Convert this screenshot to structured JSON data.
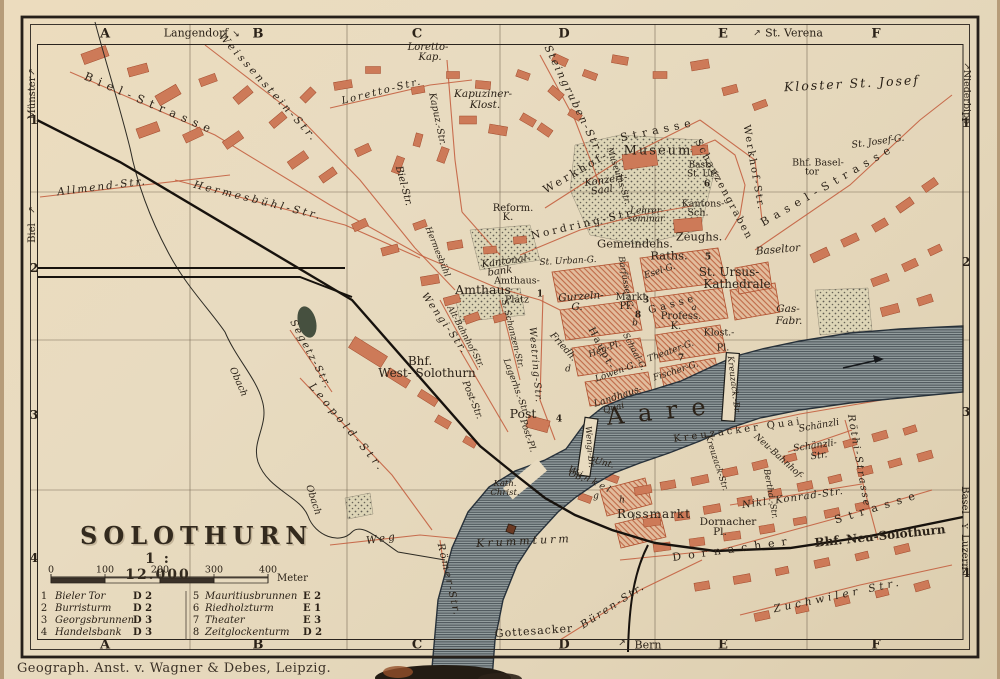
{
  "photo": {
    "credit": "Geograph. Anst. v. Wagner & Debes, Leipzig."
  },
  "map": {
    "title": "SOLOTHURN",
    "scale_text": "1 : 12.000",
    "scale_bar": {
      "unit": "Meter",
      "ticks": [
        {
          "t": "0",
          "x": 51
        },
        {
          "t": "100",
          "x": 105
        },
        {
          "t": "200",
          "x": 160
        },
        {
          "t": "300",
          "x": 214
        },
        {
          "t": "400",
          "x": 268
        }
      ]
    },
    "grid": {
      "cols": [
        {
          "t": "A",
          "x": 105
        },
        {
          "t": "B",
          "x": 258
        },
        {
          "t": "C",
          "x": 417
        },
        {
          "t": "D",
          "x": 564
        },
        {
          "t": "E",
          "x": 723
        },
        {
          "t": "F",
          "x": 876
        }
      ],
      "rows_left": [
        {
          "t": "1",
          "y": 120
        },
        {
          "t": "2",
          "y": 268
        },
        {
          "t": "3",
          "y": 415
        },
        {
          "t": "4",
          "y": 558
        }
      ],
      "rows_right": [
        {
          "t": "1",
          "y": 123
        },
        {
          "t": "2",
          "y": 262
        },
        {
          "t": "3",
          "y": 412
        },
        {
          "t": "4",
          "y": 573
        }
      ]
    },
    "legend": {
      "entries": [
        {
          "num": "1",
          "name": "Bieler Tor",
          "ref": "D 2"
        },
        {
          "num": "2",
          "name": "Burristurm",
          "ref": "D 2"
        },
        {
          "num": "3",
          "name": "Georgsbrunnen",
          "ref": "D 3"
        },
        {
          "num": "4",
          "name": "Handelsbank",
          "ref": "D 3"
        },
        {
          "num": "5",
          "name": "Mauritiusbrunnen",
          "ref": "E 2"
        },
        {
          "num": "6",
          "name": "Riedholzturm",
          "ref": "E 1"
        },
        {
          "num": "7",
          "name": "Theater",
          "ref": "E 3"
        },
        {
          "num": "8",
          "name": "Zeitglockenturm",
          "ref": "D 2"
        }
      ]
    },
    "colors": {
      "paper": "#e8dbc0",
      "ink": "#2b2218",
      "building_red": "#c2593a",
      "water": "#8f999c"
    },
    "labels": [
      {
        "t": "Langendorf",
        "x": 196,
        "y": 33,
        "s": 11,
        "n": "edge-label-langendorf"
      },
      {
        "t": "↘",
        "x": 236,
        "y": 35,
        "s": 9,
        "n": "direction-arrow"
      },
      {
        "t": "↗",
        "x": 757,
        "y": 34,
        "s": 9,
        "n": "direction-arrow"
      },
      {
        "t": "St. Verena",
        "x": 794,
        "y": 33,
        "s": 11,
        "n": "edge-label-st-verena"
      },
      {
        "t": "↗",
        "x": 33,
        "y": 72,
        "r": -90,
        "s": 9,
        "n": "direction-arrow"
      },
      {
        "t": "Münster",
        "x": 33,
        "y": 98,
        "r": -90,
        "s": 10,
        "n": "edge-label-muenster"
      },
      {
        "t": "↗",
        "x": 33,
        "y": 210,
        "r": -90,
        "s": 9,
        "n": "direction-arrow"
      },
      {
        "t": "Biel",
        "x": 33,
        "y": 233,
        "r": -90,
        "s": 10,
        "n": "edge-label-biel"
      },
      {
        "t": "↗",
        "x": 966,
        "y": 66,
        "r": 90,
        "s": 9,
        "n": "direction-arrow"
      },
      {
        "t": "Niederbipp",
        "x": 966,
        "y": 97,
        "r": 90,
        "s": 9.5,
        "n": "edge-label-niederbipp"
      },
      {
        "t": "Basel",
        "x": 964,
        "y": 500,
        "r": 90,
        "s": 10,
        "n": "edge-label-basel"
      },
      {
        "t": "Y",
        "x": 964,
        "y": 526,
        "r": 90,
        "s": 8,
        "n": "rail-fork-icon"
      },
      {
        "t": "Luzern",
        "x": 964,
        "y": 552,
        "r": 90,
        "s": 10,
        "n": "edge-label-luzern"
      },
      {
        "t": "↗",
        "x": 622,
        "y": 644,
        "s": 9,
        "n": "direction-arrow"
      },
      {
        "t": "Bern",
        "x": 648,
        "y": 645,
        "s": 11,
        "n": "edge-label-bern"
      },
      {
        "t": "Weissenstein-Str.",
        "x": 268,
        "y": 88,
        "r": 48,
        "s": 10.5,
        "i": 1,
        "ls": 3
      },
      {
        "t": "Biel-Strasse",
        "x": 150,
        "y": 104,
        "r": 23,
        "s": 11.5,
        "ls": 6
      },
      {
        "t": "Loretto-Str.",
        "x": 382,
        "y": 92,
        "r": -14,
        "s": 10,
        "i": 1,
        "ls": 2
      },
      {
        "t": "Loretto-",
        "x": 428,
        "y": 48,
        "s": 10,
        "i": 1
      },
      {
        "t": "Kap.",
        "x": 430,
        "y": 58,
        "s": 10,
        "i": 1
      },
      {
        "t": "Kapuziner-",
        "x": 483,
        "y": 94,
        "s": 10.5,
        "i": 1
      },
      {
        "t": "Klost.",
        "x": 485,
        "y": 105,
        "s": 10.5,
        "i": 1
      },
      {
        "t": "Kapuz.-Str.",
        "x": 437,
        "y": 119,
        "r": 78,
        "s": 9.5,
        "i": 1
      },
      {
        "t": "Allmend-Str.",
        "x": 102,
        "y": 187,
        "r": -7,
        "s": 10.5,
        "i": 1,
        "ls": 2
      },
      {
        "t": "Hermesbühl-Str.",
        "x": 258,
        "y": 201,
        "r": 14,
        "s": 10.5,
        "i": 1,
        "ls": 3
      },
      {
        "t": "Biel-Str.",
        "x": 403,
        "y": 186,
        "r": 75,
        "s": 10,
        "i": 1
      },
      {
        "t": "Hermesbühl",
        "x": 437,
        "y": 252,
        "r": 68,
        "s": 8.5,
        "i": 1
      },
      {
        "t": "Steingruben-Str.",
        "x": 573,
        "y": 100,
        "r": 64,
        "s": 10.5,
        "i": 1,
        "ls": 2
      },
      {
        "t": "Werkhof-",
        "x": 576,
        "y": 172,
        "r": -30,
        "s": 11,
        "ls": 3
      },
      {
        "t": "Strasse",
        "x": 658,
        "y": 130,
        "r": -12,
        "s": 11,
        "ls": 5
      },
      {
        "t": "Werkhof-Str.",
        "x": 753,
        "y": 168,
        "r": 80,
        "s": 10,
        "ls": 2
      },
      {
        "t": "Museum",
        "x": 658,
        "y": 151,
        "s": 13,
        "ls": 2
      },
      {
        "t": "Museums-Str.",
        "x": 618,
        "y": 176,
        "r": 72,
        "s": 8.5,
        "i": 1
      },
      {
        "t": "Konzert-",
        "x": 606,
        "y": 181,
        "r": -8,
        "s": 10,
        "i": 1
      },
      {
        "t": "Saal",
        "x": 602,
        "y": 191,
        "r": -8,
        "s": 10,
        "i": 1
      },
      {
        "t": "Schanzengraben",
        "x": 723,
        "y": 190,
        "r": 62,
        "s": 10,
        "ls": 2
      },
      {
        "t": "Bast.",
        "x": 700,
        "y": 166,
        "s": 9
      },
      {
        "t": "St. Urs",
        "x": 703,
        "y": 175,
        "s": 9
      },
      {
        "t": "6",
        "x": 707,
        "y": 185,
        "s": 9,
        "b": 1,
        "n": "map-ref-marker"
      },
      {
        "t": "Kloster St. Josef",
        "x": 852,
        "y": 84,
        "r": -3,
        "s": 12.5,
        "i": 1,
        "ls": 2
      },
      {
        "t": "Bhf. Basel-",
        "x": 818,
        "y": 163,
        "s": 9.5
      },
      {
        "t": "tor",
        "x": 812,
        "y": 172,
        "s": 9.5
      },
      {
        "t": "Basel-Strasse",
        "x": 828,
        "y": 185,
        "r": -30,
        "s": 11,
        "ls": 6
      },
      {
        "t": "St. Josef-G.",
        "x": 878,
        "y": 142,
        "r": -8,
        "s": 9.5,
        "i": 1
      },
      {
        "t": "Reform.",
        "x": 513,
        "y": 209,
        "s": 10
      },
      {
        "t": "K.",
        "x": 508,
        "y": 218,
        "s": 10
      },
      {
        "t": "Nordring-Str.",
        "x": 585,
        "y": 224,
        "r": -13,
        "s": 10.5,
        "ls": 3
      },
      {
        "t": "Lehrer-",
        "x": 647,
        "y": 212,
        "s": 9,
        "i": 1
      },
      {
        "t": "seminar",
        "x": 646,
        "y": 220,
        "s": 9,
        "i": 1
      },
      {
        "t": "Kantons-",
        "x": 703,
        "y": 204,
        "s": 9.5
      },
      {
        "t": "Sch.",
        "x": 698,
        "y": 213,
        "s": 9.5
      },
      {
        "t": "Gemeindehs.",
        "x": 635,
        "y": 244,
        "s": 11.5
      },
      {
        "t": "Zeughs.",
        "x": 699,
        "y": 237,
        "s": 11.5
      },
      {
        "t": "Raths.",
        "x": 669,
        "y": 256,
        "s": 11.5
      },
      {
        "t": "5",
        "x": 708,
        "y": 258,
        "s": 9,
        "b": 1,
        "n": "map-ref-marker"
      },
      {
        "t": "St. Ursus-",
        "x": 729,
        "y": 272,
        "s": 12
      },
      {
        "t": "Kathedrale",
        "x": 737,
        "y": 284,
        "s": 12
      },
      {
        "t": "Baseltor",
        "x": 778,
        "y": 250,
        "r": -5,
        "s": 10.5,
        "i": 1
      },
      {
        "t": "Gas-",
        "x": 788,
        "y": 309,
        "s": 10.5,
        "i": 1
      },
      {
        "t": "Fabr.",
        "x": 789,
        "y": 321,
        "s": 10.5,
        "i": 1
      },
      {
        "t": "Kantonal-",
        "x": 506,
        "y": 262,
        "r": -8,
        "s": 10,
        "i": 1
      },
      {
        "t": "bank",
        "x": 500,
        "y": 272,
        "r": -8,
        "s": 10,
        "i": 1
      },
      {
        "t": "St. Urban-G.",
        "x": 568,
        "y": 262,
        "r": -3,
        "s": 9,
        "i": 1
      },
      {
        "t": "Amthaus",
        "x": 483,
        "y": 290,
        "s": 12.5
      },
      {
        "t": "Amthaus-",
        "x": 517,
        "y": 281,
        "s": 9.5
      },
      {
        "t": "Platz",
        "x": 517,
        "y": 300,
        "s": 9.5
      },
      {
        "t": "1",
        "x": 540,
        "y": 295,
        "s": 9,
        "b": 1,
        "n": "map-ref-marker"
      },
      {
        "t": "Gurzeln-",
        "x": 581,
        "y": 297,
        "r": -4,
        "s": 10.5,
        "i": 1
      },
      {
        "t": "G.",
        "x": 577,
        "y": 307,
        "s": 10.5,
        "i": 1
      },
      {
        "t": "Markt",
        "x": 631,
        "y": 298,
        "s": 10
      },
      {
        "t": "Pl.",
        "x": 626,
        "y": 307,
        "s": 10
      },
      {
        "t": "3",
        "x": 646,
        "y": 301,
        "s": 9,
        "b": 1,
        "n": "map-ref-marker"
      },
      {
        "t": "8",
        "x": 638,
        "y": 316,
        "s": 9,
        "b": 1,
        "n": "map-ref-marker"
      },
      {
        "t": "b",
        "x": 635,
        "y": 324,
        "s": 9,
        "i": 1,
        "n": "map-ref-marker"
      },
      {
        "t": "Esel-G.",
        "x": 660,
        "y": 272,
        "r": -18,
        "s": 9,
        "i": 1
      },
      {
        "t": "Barfüsser-G.",
        "x": 625,
        "y": 283,
        "r": 80,
        "s": 8.5,
        "i": 1
      },
      {
        "t": "Profess.",
        "x": 681,
        "y": 317,
        "s": 10
      },
      {
        "t": "K.",
        "x": 676,
        "y": 327,
        "s": 10
      },
      {
        "t": "a",
        "x": 694,
        "y": 308,
        "s": 8.5,
        "i": 1,
        "n": "map-ref-marker"
      },
      {
        "t": "Klost.-",
        "x": 719,
        "y": 333,
        "s": 9.5
      },
      {
        "t": "Pl.",
        "x": 723,
        "y": 348,
        "s": 9.5
      },
      {
        "t": "Haupt-",
        "x": 601,
        "y": 349,
        "r": 62,
        "s": 10,
        "ls": 2
      },
      {
        "t": "Gasse",
        "x": 673,
        "y": 305,
        "r": -15,
        "s": 10,
        "ls": 4
      },
      {
        "t": "Wengi-Str.",
        "x": 444,
        "y": 324,
        "r": 55,
        "s": 10,
        "i": 1,
        "ls": 2
      },
      {
        "t": "Alt-Bahnhof-Str.",
        "x": 465,
        "y": 337,
        "r": 62,
        "s": 8.5,
        "i": 1
      },
      {
        "t": "S. Schanzen-Str.",
        "x": 512,
        "y": 334,
        "r": 76,
        "s": 8.5,
        "i": 1
      },
      {
        "t": "Westring-Str.",
        "x": 535,
        "y": 365,
        "r": 85,
        "s": 9.5,
        "i": 1,
        "ls": 1
      },
      {
        "t": "Friedh.",
        "x": 563,
        "y": 347,
        "r": 48,
        "s": 9.5,
        "i": 1
      },
      {
        "t": "d",
        "x": 568,
        "y": 370,
        "s": 9,
        "i": 1,
        "n": "map-ref-marker"
      },
      {
        "t": "Heu-Pl.",
        "x": 605,
        "y": 350,
        "r": -20,
        "s": 9,
        "i": 1
      },
      {
        "t": "Schaal-G.",
        "x": 634,
        "y": 352,
        "r": 62,
        "s": 8.5,
        "i": 1
      },
      {
        "t": "Löwen-G.",
        "x": 616,
        "y": 373,
        "r": -20,
        "s": 9,
        "i": 1
      },
      {
        "t": "Theater-G.",
        "x": 671,
        "y": 352,
        "r": -20,
        "s": 9,
        "i": 1
      },
      {
        "t": "7",
        "x": 681,
        "y": 359,
        "s": 9,
        "b": 1,
        "n": "map-ref-marker"
      },
      {
        "t": "Fischer-G.",
        "x": 676,
        "y": 372,
        "r": -18,
        "s": 9,
        "i": 1
      },
      {
        "t": "Landhaus-",
        "x": 618,
        "y": 397,
        "r": -18,
        "s": 9.5,
        "i": 1
      },
      {
        "t": "Quai",
        "x": 614,
        "y": 409,
        "r": -15,
        "s": 9,
        "i": 1
      },
      {
        "t": "Aare",
        "x": 663,
        "y": 411,
        "r": -6,
        "s": 24,
        "ls": 14
      },
      {
        "t": "Post",
        "x": 523,
        "y": 414,
        "s": 12.5
      },
      {
        "t": "Post-Pl.",
        "x": 527,
        "y": 436,
        "r": 72,
        "s": 9,
        "i": 1
      },
      {
        "t": "4",
        "x": 559,
        "y": 420,
        "s": 9,
        "b": 1,
        "n": "map-ref-marker"
      },
      {
        "t": "Post-Str.",
        "x": 472,
        "y": 400,
        "r": 68,
        "s": 9.5,
        "i": 1
      },
      {
        "t": "Lagerhs.-Str.",
        "x": 515,
        "y": 387,
        "r": 70,
        "s": 9,
        "i": 1
      },
      {
        "t": "Bhf.",
        "x": 420,
        "y": 361,
        "s": 12
      },
      {
        "t": "West- Solothurn",
        "x": 427,
        "y": 373,
        "s": 12
      },
      {
        "t": "Leopold-Str.",
        "x": 347,
        "y": 428,
        "r": 50,
        "s": 10.5,
        "i": 1,
        "ls": 4
      },
      {
        "t": "Segetz-Str.",
        "x": 310,
        "y": 355,
        "r": 62,
        "s": 10,
        "i": 1,
        "ls": 2
      },
      {
        "t": "Obach",
        "x": 238,
        "y": 382,
        "r": 66,
        "s": 9.5,
        "i": 1
      },
      {
        "t": "Obach",
        "x": 313,
        "y": 500,
        "r": 72,
        "s": 9.5,
        "i": 1
      },
      {
        "t": "Weg",
        "x": 382,
        "y": 539,
        "r": -8,
        "s": 10.5,
        "i": 1,
        "ls": 3
      },
      {
        "t": "Römer-Str.",
        "x": 448,
        "y": 580,
        "r": 77,
        "s": 10,
        "i": 1,
        "ls": 2
      },
      {
        "t": "Gottesacker",
        "x": 534,
        "y": 631,
        "r": -4,
        "s": 11,
        "ls": 1
      },
      {
        "t": "Büren-Str.",
        "x": 613,
        "y": 606,
        "r": -33,
        "s": 10.5,
        "i": 1,
        "ls": 2
      },
      {
        "t": "Krummturm",
        "x": 524,
        "y": 541,
        "r": -3,
        "s": 11,
        "i": 1,
        "ls": 3
      },
      {
        "t": "Kath.",
        "x": 505,
        "y": 484,
        "s": 8.5,
        "i": 1
      },
      {
        "t": "Christ.",
        "x": 505,
        "y": 493,
        "s": 8.5,
        "i": 1
      },
      {
        "t": "Ob.",
        "x": 576,
        "y": 477,
        "r": 20,
        "s": 9,
        "i": 1
      },
      {
        "t": "Unt.",
        "x": 604,
        "y": 464,
        "r": 15,
        "s": 9,
        "i": 1
      },
      {
        "t": "Winkel",
        "x": 590,
        "y": 481,
        "r": 28,
        "s": 9,
        "i": 1,
        "ls": 3
      },
      {
        "t": "g",
        "x": 596,
        "y": 497,
        "s": 9,
        "i": 1,
        "n": "map-ref-marker"
      },
      {
        "t": "h",
        "x": 622,
        "y": 501,
        "s": 9,
        "i": 1,
        "n": "map-ref-marker"
      },
      {
        "t": "i",
        "x": 634,
        "y": 518,
        "s": 9,
        "i": 1,
        "n": "map-ref-marker"
      },
      {
        "t": "Rossmarkt",
        "x": 654,
        "y": 514,
        "s": 12,
        "ls": 1
      },
      {
        "t": "Wengi-Br.",
        "x": 589,
        "y": 447,
        "r": 85,
        "s": 8.5,
        "i": 1
      },
      {
        "t": "Kreuzack.-Br.",
        "x": 733,
        "y": 385,
        "r": 83,
        "s": 8.5,
        "i": 1
      },
      {
        "t": "Kreuzacker Quai",
        "x": 738,
        "y": 431,
        "r": -8,
        "s": 10,
        "ls": 3
      },
      {
        "t": "Schänzli",
        "x": 819,
        "y": 426,
        "r": -10,
        "s": 9.5,
        "i": 1
      },
      {
        "t": "Schänzli-",
        "x": 815,
        "y": 446,
        "r": -8,
        "s": 9.5,
        "i": 1
      },
      {
        "t": "Str.",
        "x": 819,
        "y": 456,
        "r": -8,
        "s": 9.5,
        "i": 1
      },
      {
        "t": "Röthi-Strasse",
        "x": 858,
        "y": 461,
        "r": 80,
        "s": 10,
        "i": 1,
        "ls": 2
      },
      {
        "t": "Kreuzack-Str.",
        "x": 716,
        "y": 463,
        "r": 72,
        "s": 8.5,
        "i": 1
      },
      {
        "t": "Neu-Bahnhof-",
        "x": 778,
        "y": 457,
        "r": 42,
        "s": 9,
        "i": 1
      },
      {
        "t": "Berthd.-Str.",
        "x": 770,
        "y": 494,
        "r": 80,
        "s": 8.5,
        "i": 1
      },
      {
        "t": "Nikl. Konrad-Str.",
        "x": 793,
        "y": 499,
        "r": -8,
        "s": 10,
        "i": 1,
        "ls": 1
      },
      {
        "t": "Dornacher",
        "x": 728,
        "y": 522,
        "s": 10.5
      },
      {
        "t": "Pl.",
        "x": 720,
        "y": 532,
        "s": 10.5
      },
      {
        "t": "Dornacher",
        "x": 733,
        "y": 549,
        "r": -8,
        "s": 11,
        "ls": 7
      },
      {
        "t": "Strasse",
        "x": 878,
        "y": 507,
        "r": -17,
        "s": 11,
        "ls": 7
      },
      {
        "t": "Bhf. Neu-Solothurn",
        "x": 880,
        "y": 536,
        "r": -6,
        "s": 12,
        "b": 1
      },
      {
        "t": "Zuchwiler Str.",
        "x": 838,
        "y": 596,
        "r": -12,
        "s": 10.5,
        "i": 1,
        "ls": 4
      }
    ]
  }
}
